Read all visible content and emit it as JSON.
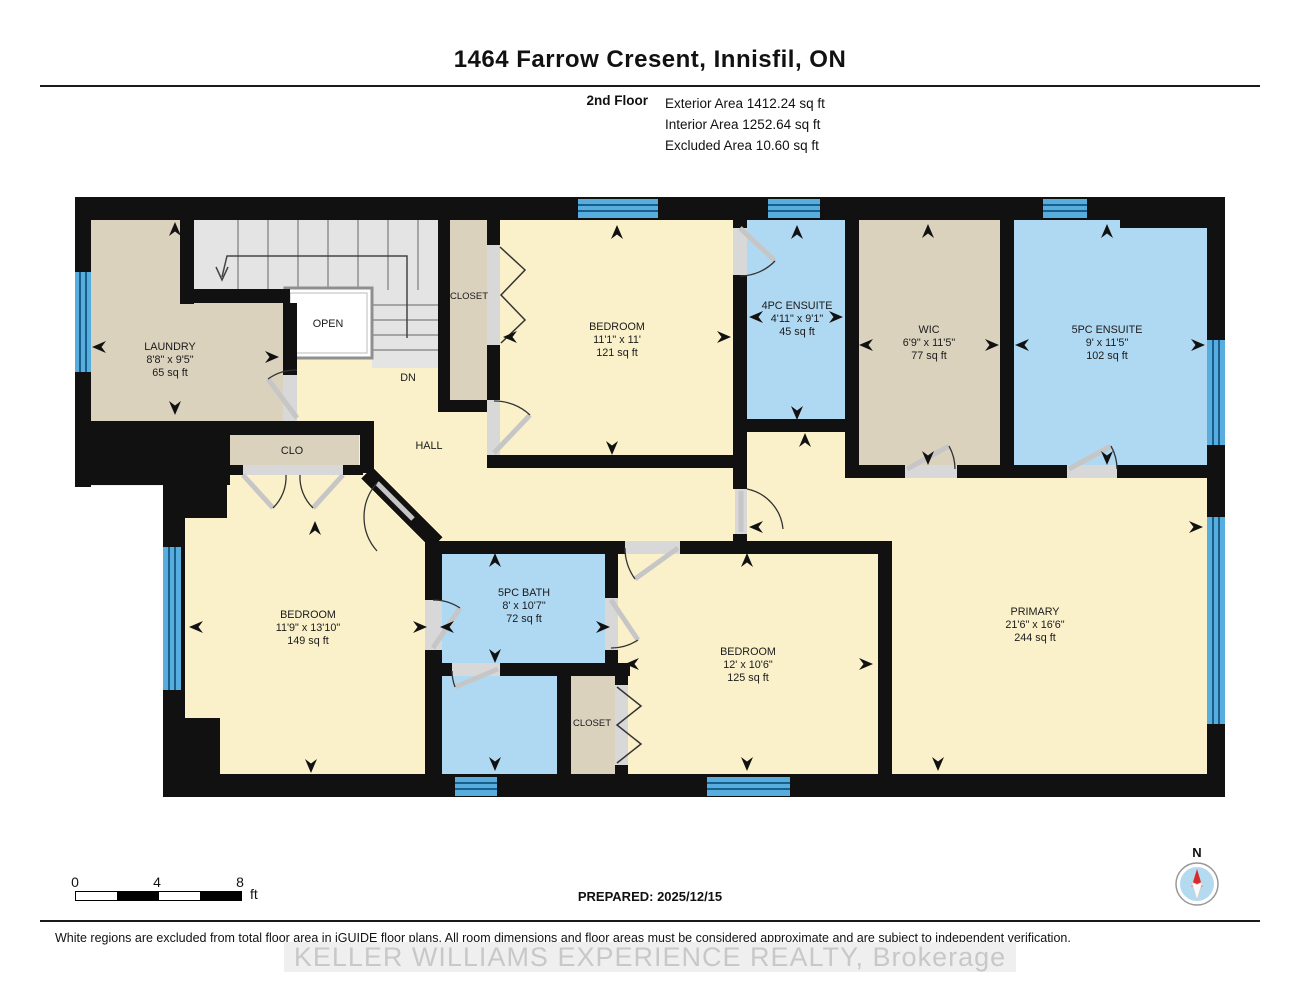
{
  "header": {
    "title": "1464 Farrow Cresent, Innisfil, ON",
    "floor_label": "2nd Floor",
    "stats": [
      "Exterior Area 1412.24 sq ft",
      "Interior Area 1252.64 sq ft",
      "Excluded Area 10.60 sq ft"
    ]
  },
  "rooms": [
    {
      "name": "LAUNDRY",
      "dims": "8'8\" x 9'5\"",
      "area": "65 sq ft"
    },
    {
      "name": "BEDROOM",
      "dims": "11'1\" x 11'",
      "area": "121 sq ft"
    },
    {
      "name": "4PC ENSUITE",
      "dims": "4'11\" x 9'1\"",
      "area": "45 sq ft"
    },
    {
      "name": "WIC",
      "dims": "6'9\" x 11'5\"",
      "area": "77 sq ft"
    },
    {
      "name": "5PC ENSUITE",
      "dims": "9' x 11'5\"",
      "area": "102 sq ft"
    },
    {
      "name": "BEDROOM",
      "dims": "11'9\" x 13'10\"",
      "area": "149 sq ft"
    },
    {
      "name": "5PC BATH",
      "dims": "8' x 10'7\"",
      "area": "72 sq ft"
    },
    {
      "name": "BEDROOM",
      "dims": "12' x 10'6\"",
      "area": "125 sq ft"
    },
    {
      "name": "PRIMARY",
      "dims": "21'6\" x 16'6\"",
      "area": "244 sq ft"
    }
  ],
  "labels": {
    "open": "OPEN",
    "dn": "DN",
    "hall": "HALL",
    "clo": "CLO",
    "closet_top": "CLOSET",
    "closet_bottom": "CLOSET"
  },
  "scale_bar": {
    "ticks": [
      "0",
      "4",
      "8"
    ],
    "unit": "ft"
  },
  "prepared": "PREPARED: 2025/12/15",
  "compass": {
    "north_label": "N"
  },
  "footer": {
    "disclaimer": "White regions are excluded from total floor area in iGUIDE floor plans. All room dimensions and floor areas must be considered approximate and are subject to independent verification.",
    "watermark": "KELLER WILLIAMS EXPERIENCE REALTY, Brokerage"
  },
  "colors": {
    "wall": "#111111",
    "room_cream": "#FAF1CB",
    "room_beige": "#DBD2BE",
    "room_blue": "#AFD9F2",
    "stairs_gray": "#E4E4E4",
    "window_blue": "#58ADDF",
    "window_line": "#1A5E8C",
    "door_sill": "#D8D8D8",
    "compass_red": "#D92B2B",
    "watermark_gray": "#C8C8C8"
  }
}
